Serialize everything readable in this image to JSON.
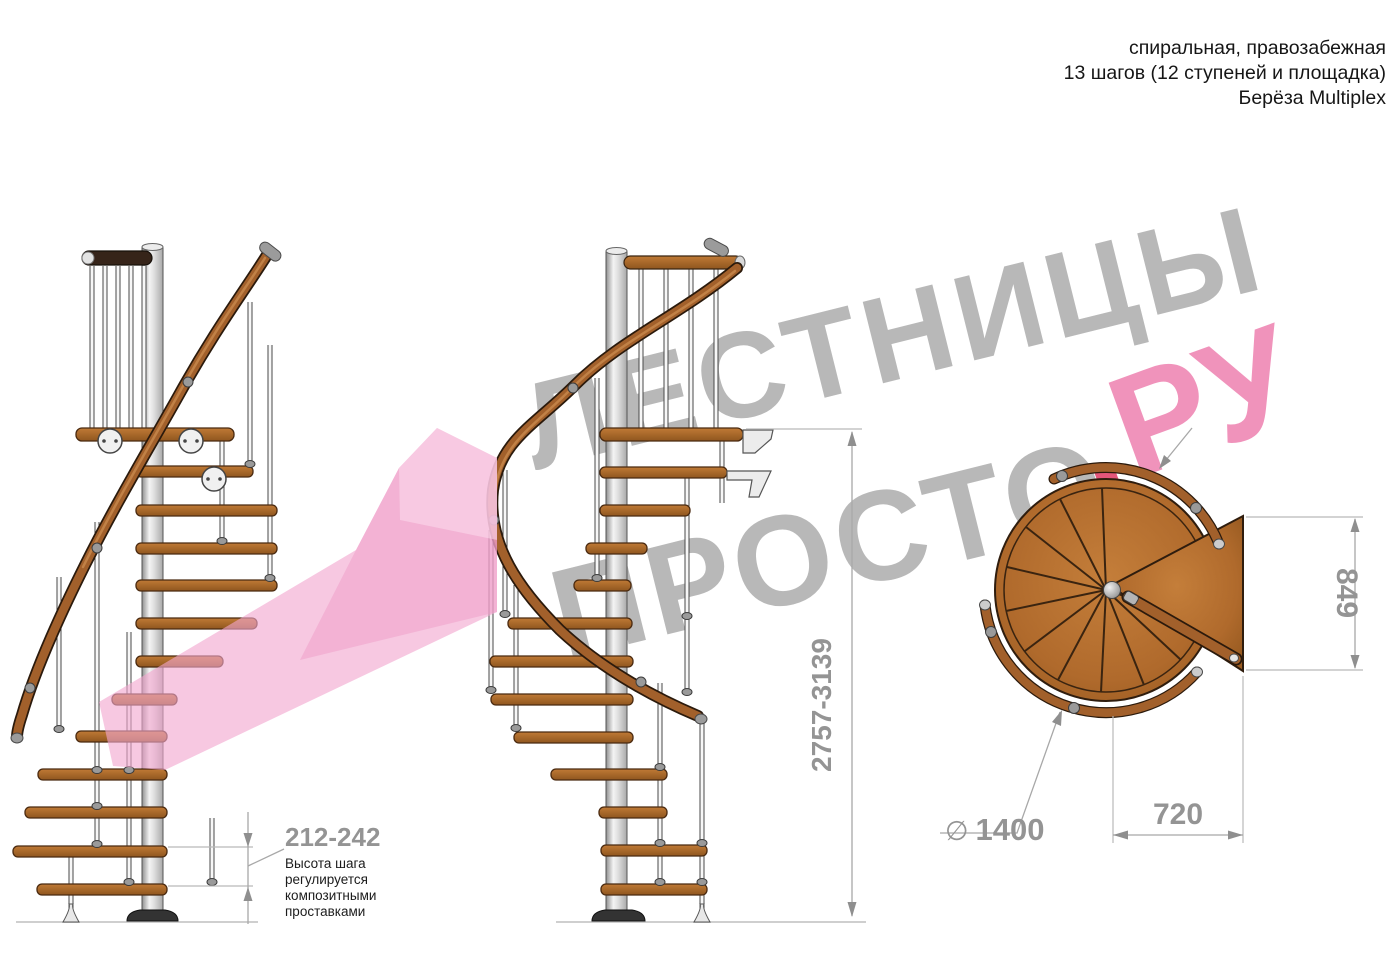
{
  "header": {
    "lines": [
      "спиральная, правозабежная",
      "13 шагов (12 ступеней и площадка)",
      "Берёза Multiplex"
    ]
  },
  "watermark": {
    "word1": "ЛЕСТНИЦЫ",
    "word2": "ПРОСТО",
    "dot": ".",
    "suffix": "РУ"
  },
  "dimensions": {
    "step_height": {
      "value": "212-242",
      "note": [
        "Высота шага",
        "регулируется",
        "композитными",
        "проставками"
      ]
    },
    "total_height": {
      "value": "2757-3139"
    },
    "landing_depth": {
      "value": "849"
    },
    "landing_width": {
      "value": "720"
    },
    "diameter": {
      "symbol": "∅",
      "value": "1400"
    }
  },
  "views": {
    "left": "side elevation",
    "front": "side elevation rotated",
    "plan": "top plan view"
  },
  "colors": {
    "wood": "#b4702e",
    "wood_line": "#3a2410",
    "handrail": "#a2602b",
    "metal_pole": "#c9c9c9",
    "dimension_gray": "#949494",
    "note_black": "#1c1c1c",
    "watermark_gray": "#b3b3b3",
    "watermark_pink": "#ef8ab6",
    "watermark_dot_pink": "#e2486f",
    "arrow_pink": "#f2a7cf"
  }
}
